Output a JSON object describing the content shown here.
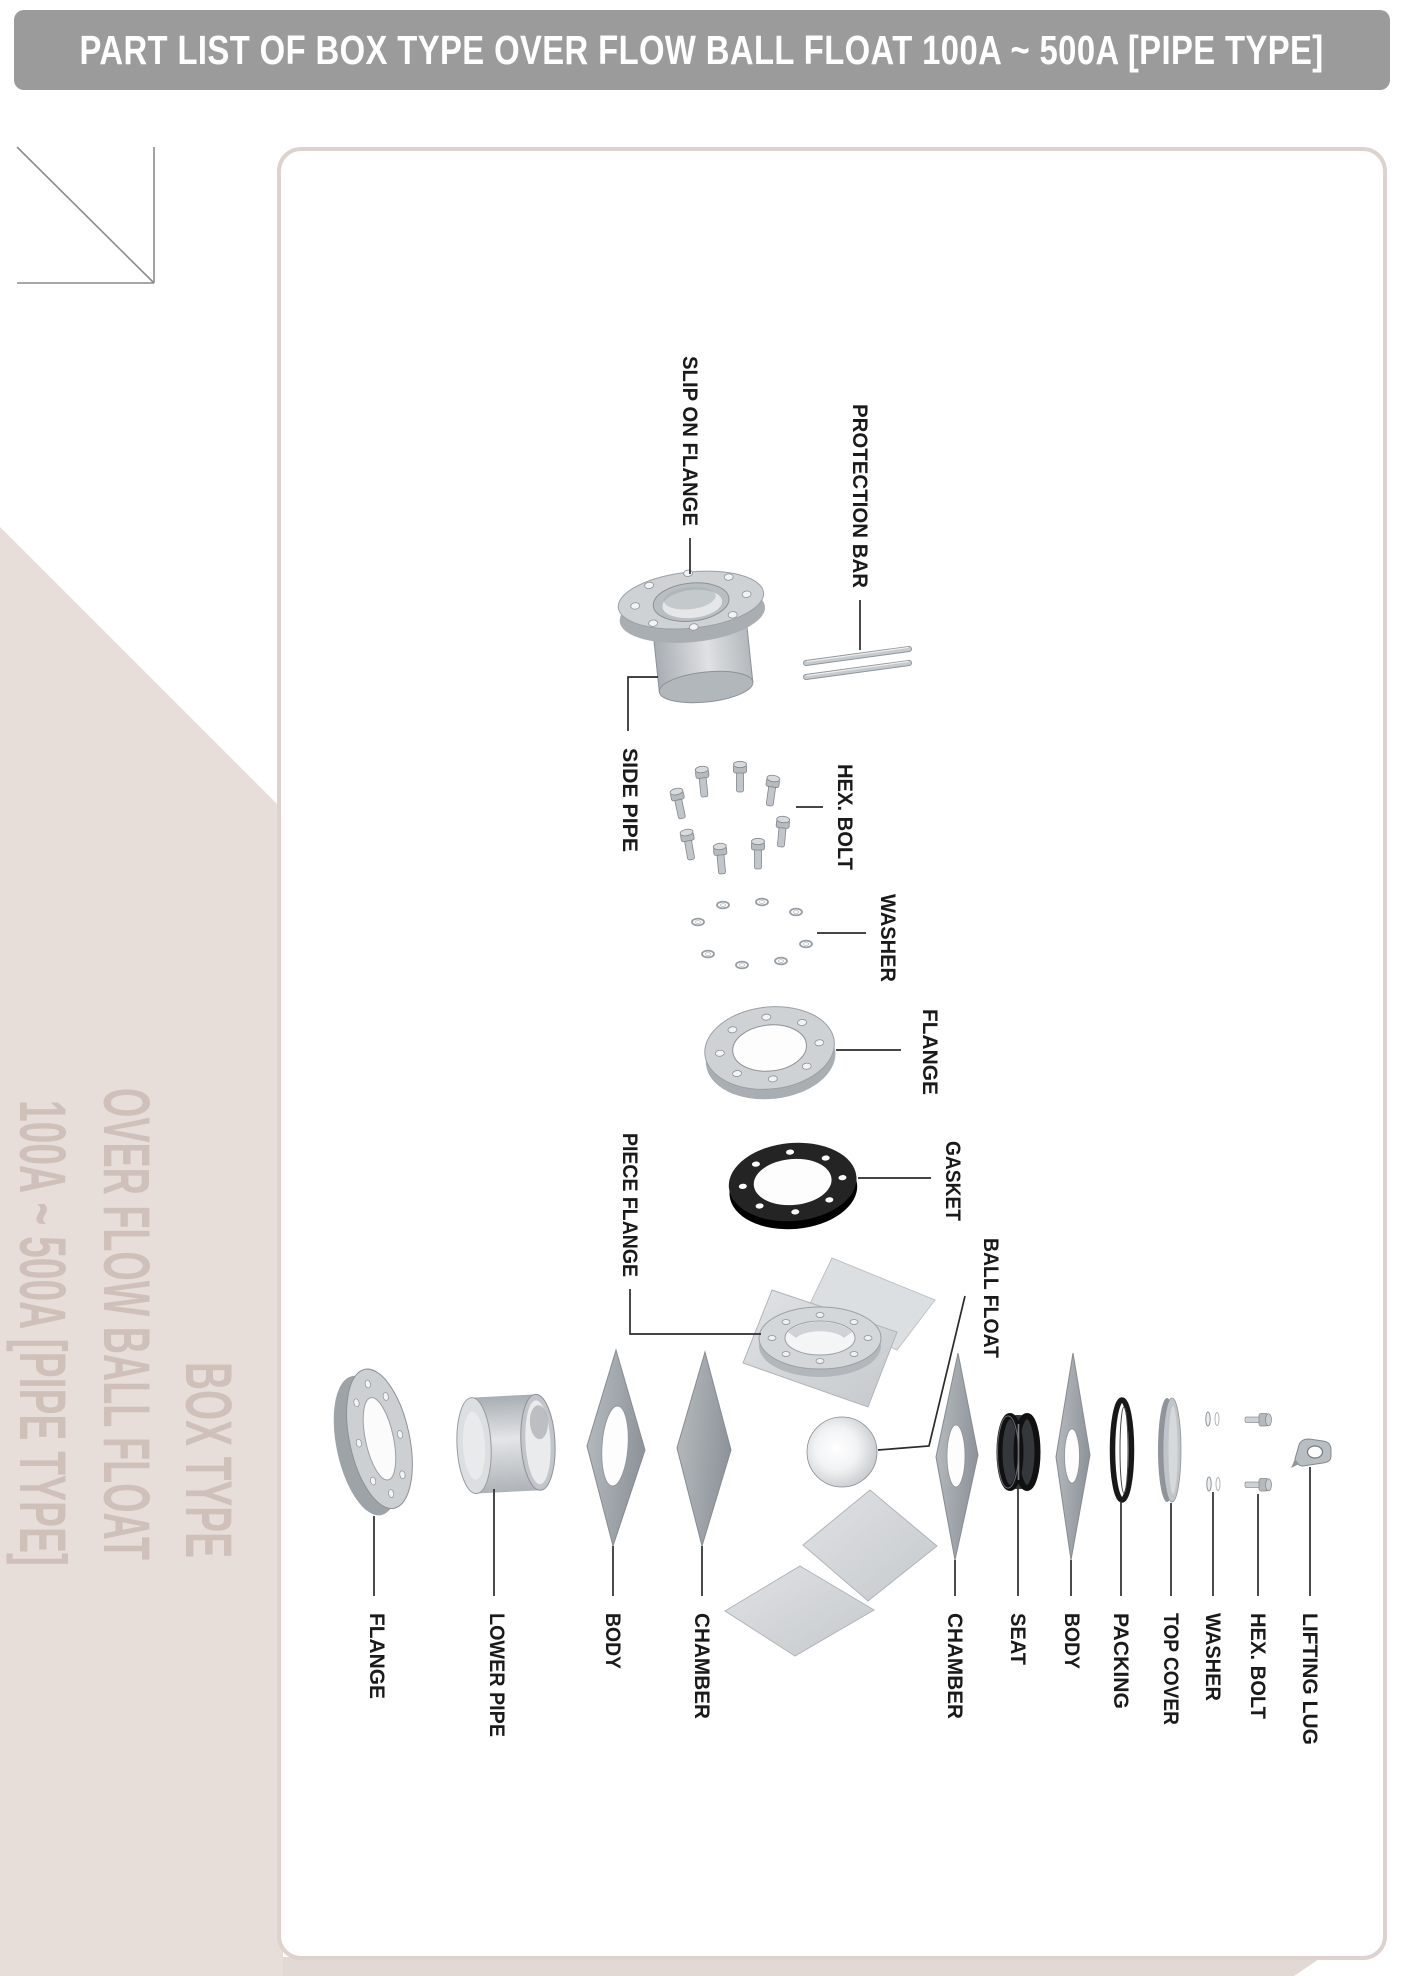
{
  "header": {
    "title": "PART LIST OF BOX TYPE OVER FLOW BALL FLOAT 100A ~ 500A [PIPE TYPE]"
  },
  "sidebar": {
    "line1": "BOX TYPE",
    "line2": "OVER FLOW BALL FLOAT",
    "line3": "100A ~ 500A [PIPE TYPE]"
  },
  "colors": {
    "header_bar": "#9b9b9b",
    "header_text": "#ffffff",
    "sidebar_bg": "#e7ddd9",
    "sidebar_text": "#cfc0ba",
    "panel_border": "#ddd2ce",
    "label_text": "#1a1a1a",
    "leader_line": "#2b2b2b",
    "part_gray": "#ced2d5",
    "part_dark": "#1e1e1e"
  },
  "diagram": {
    "labels": [
      {
        "id": "slip-on-flange",
        "text": "SLIP ON FLANGE"
      },
      {
        "id": "protection-bar",
        "text": "PROTECTION BAR"
      },
      {
        "id": "side-pipe",
        "text": "SIDE PIPE"
      },
      {
        "id": "hex-bolt-top",
        "text": "HEX. BOLT"
      },
      {
        "id": "washer-top",
        "text": "WASHER"
      },
      {
        "id": "flange-mid",
        "text": "FLANGE"
      },
      {
        "id": "gasket",
        "text": "GASKET"
      },
      {
        "id": "piece-flange",
        "text": "PIECE FLANGE"
      },
      {
        "id": "ball-float",
        "text": "BALL FLOAT"
      },
      {
        "id": "flange-bottom",
        "text": "FLANGE"
      },
      {
        "id": "lower-pipe",
        "text": "LOWER PIPE"
      },
      {
        "id": "body-left",
        "text": "BODY"
      },
      {
        "id": "chamber-left",
        "text": "CHAMBER"
      },
      {
        "id": "chamber-right",
        "text": "CHAMBER"
      },
      {
        "id": "seat",
        "text": "SEAT"
      },
      {
        "id": "body-right",
        "text": "BODY"
      },
      {
        "id": "packing",
        "text": "PACKING"
      },
      {
        "id": "top-cover",
        "text": "TOP COVER"
      },
      {
        "id": "washer-bottom",
        "text": "WASHER"
      },
      {
        "id": "hex-bolt-bottom",
        "text": "HEX. BOLT"
      },
      {
        "id": "lifting-lug",
        "text": "LIFTING LUG"
      }
    ]
  }
}
